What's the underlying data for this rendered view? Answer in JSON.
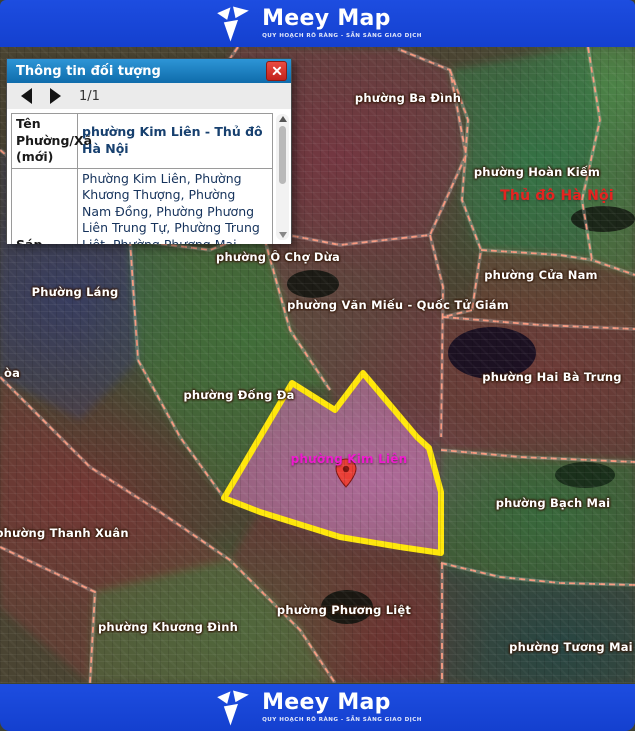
{
  "brand": {
    "name": "Meey Map",
    "tagline": "QUY HOẠCH RÕ RÀNG - SẴN SÀNG GIAO DỊCH"
  },
  "popup": {
    "title": "Thông tin đối tượng",
    "pager": "1/1",
    "rows": [
      {
        "label": "Tên Phường/Xã (mới)",
        "value": "phường Kim Liên - Thủ đô Hà Nội"
      },
      {
        "label": "Sáp nhập từ:",
        "value": "Phường Kim Liên, Phường Khương Thượng, Phường Nam Đồng, Phường Phương Liên Trung Tự, Phường Trung Liệt, Phường Phương Mai (phần còn lại sau khi sáp nhập vào phường Bạch"
      }
    ]
  },
  "map": {
    "selected_ward": "phường Kim Liên",
    "labels": [
      {
        "text": "phường Ba Đình"
      },
      {
        "text": "phường Hoàn Kiếm"
      },
      {
        "text": "Thủ đô Hà Nội"
      },
      {
        "text": "phường Ô Chợ Dừa"
      },
      {
        "text": "Phường Láng"
      },
      {
        "text": "phường Cửa Nam"
      },
      {
        "text": "phường Văn Miếu - Quốc Tử Giám"
      },
      {
        "text": "phường Hai Bà Trưng"
      },
      {
        "text": "òa"
      },
      {
        "text": "phường Đống Đa"
      },
      {
        "text": "phường Kim Liên"
      },
      {
        "text": "phường Bạch Mai"
      },
      {
        "text": "phường Thanh Xuân"
      },
      {
        "text": "phường Phương Liệt"
      },
      {
        "text": "phường Khương Đình"
      },
      {
        "text": "phường Tương Mai"
      }
    ],
    "colors": {
      "brand_blue": "#1d4de0",
      "boundary_line": "#ff9d82",
      "selected_outline": "#ffe70a",
      "selected_fill": "#e882cd",
      "capital_label": "#e52420",
      "selected_label": "#ee1ccd",
      "marker_red": "#ea3e36"
    }
  }
}
